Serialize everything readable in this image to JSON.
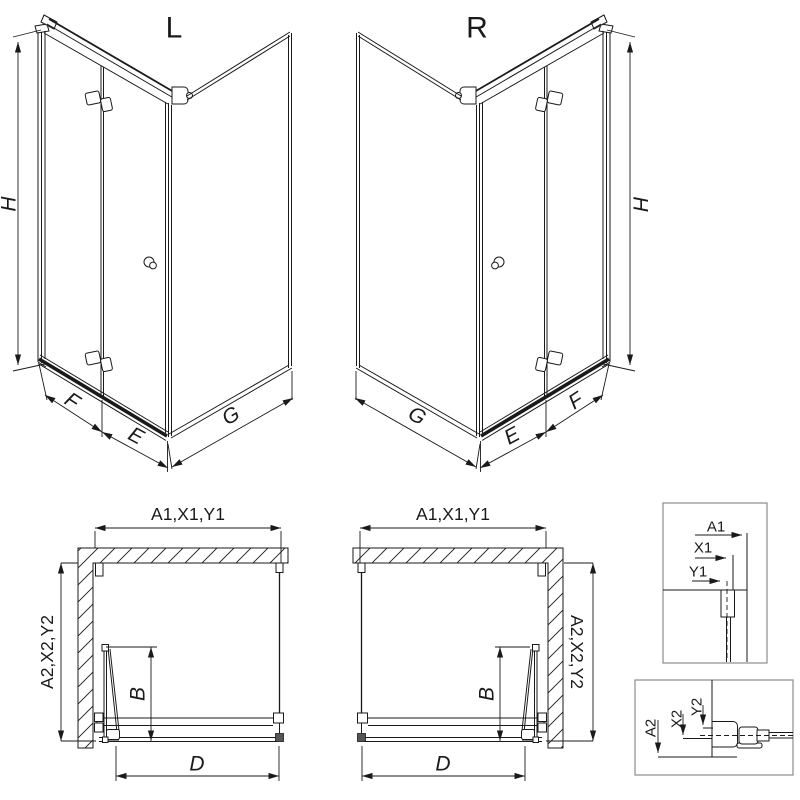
{
  "drawing": {
    "background": "#ffffff",
    "line_color": "#1a1a1a",
    "detail_frame_color": "#8c8c8c"
  },
  "iso_views": [
    {
      "label": "L",
      "height_dim": "H",
      "door_panel_dim": "F",
      "door_fixed_dim": "E",
      "side_panel_dim": "G"
    },
    {
      "label": "R",
      "height_dim": "H",
      "door_panel_dim": "F",
      "door_fixed_dim": "E",
      "side_panel_dim": "G"
    }
  ],
  "plan_views": [
    {
      "top_dims": "A1,X1,Y1",
      "side_dims": "A2,X2,Y2",
      "door_projection_dim": "B",
      "entry_width_dim": "D"
    },
    {
      "top_dims": "A1,X1,Y1",
      "side_dims": "A2,X2,Y2",
      "door_projection_dim": "B",
      "entry_width_dim": "D"
    }
  ],
  "detail_views": [
    {
      "dims": [
        "A1",
        "X1",
        "Y1"
      ]
    },
    {
      "dims": [
        "A2",
        "X2",
        "Y2"
      ]
    }
  ]
}
